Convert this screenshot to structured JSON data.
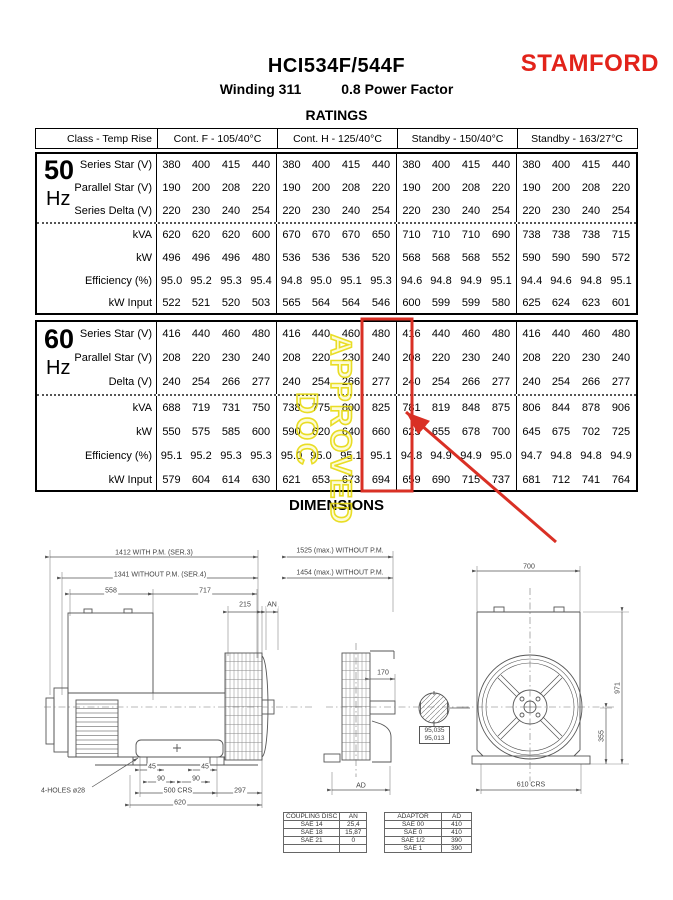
{
  "header": {
    "model": "HCI534F/544F",
    "subtitle_winding": "Winding 311",
    "subtitle_pf": "0.8 Power Factor",
    "brand": "STAMFORD"
  },
  "colors": {
    "brand_red": "#e2231a",
    "annotation_red": "#d93025",
    "watermark_yellow": "#e6d800"
  },
  "annotations": {
    "watermark": "APPROVED DOC"
  },
  "ratings": {
    "title": "RATINGS",
    "col_headers": [
      "Class - Temp Rise",
      "Cont. F - 105/40°C",
      "Cont. H - 125/40°C",
      "Standby - 150/40°C",
      "Standby - 163/27°C"
    ],
    "bands": [
      {
        "freq_big": "50",
        "freq_unit": "Hz",
        "rows": [
          {
            "label": "Series Star (V)",
            "groups": [
              [
                "380",
                "400",
                "415",
                "440"
              ],
              [
                "380",
                "400",
                "415",
                "440"
              ],
              [
                "380",
                "400",
                "415",
                "440"
              ],
              [
                "380",
                "400",
                "415",
                "440"
              ]
            ]
          },
          {
            "label": "Parallel Star (V)",
            "groups": [
              [
                "190",
                "200",
                "208",
                "220"
              ],
              [
                "190",
                "200",
                "208",
                "220"
              ],
              [
                "190",
                "200",
                "208",
                "220"
              ],
              [
                "190",
                "200",
                "208",
                "220"
              ]
            ]
          },
          {
            "label": "Series Delta (V)",
            "groups": [
              [
                "220",
                "230",
                "240",
                "254"
              ],
              [
                "220",
                "230",
                "240",
                "254"
              ],
              [
                "220",
                "230",
                "240",
                "254"
              ],
              [
                "220",
                "230",
                "240",
                "254"
              ]
            ]
          },
          {
            "label": "kVA",
            "groups": [
              [
                "620",
                "620",
                "620",
                "600"
              ],
              [
                "670",
                "670",
                "670",
                "650"
              ],
              [
                "710",
                "710",
                "710",
                "690"
              ],
              [
                "738",
                "738",
                "738",
                "715"
              ]
            ]
          },
          {
            "label": "kW",
            "groups": [
              [
                "496",
                "496",
                "496",
                "480"
              ],
              [
                "536",
                "536",
                "536",
                "520"
              ],
              [
                "568",
                "568",
                "568",
                "552"
              ],
              [
                "590",
                "590",
                "590",
                "572"
              ]
            ]
          },
          {
            "label": "Efficiency (%)",
            "groups": [
              [
                "95.0",
                "95.2",
                "95.3",
                "95.4"
              ],
              [
                "94.8",
                "95.0",
                "95.1",
                "95.3"
              ],
              [
                "94.6",
                "94.8",
                "94.9",
                "95.1"
              ],
              [
                "94.4",
                "94.6",
                "94.8",
                "95.1"
              ]
            ]
          },
          {
            "label": "kW Input",
            "groups": [
              [
                "522",
                "521",
                "520",
                "503"
              ],
              [
                "565",
                "564",
                "564",
                "546"
              ],
              [
                "600",
                "599",
                "599",
                "580"
              ],
              [
                "625",
                "624",
                "623",
                "601"
              ]
            ]
          }
        ]
      },
      {
        "freq_big": "60",
        "freq_unit": "Hz",
        "rows": [
          {
            "label": "Series Star (V)",
            "groups": [
              [
                "416",
                "440",
                "460",
                "480"
              ],
              [
                "416",
                "440",
                "460",
                "480"
              ],
              [
                "416",
                "440",
                "460",
                "480"
              ],
              [
                "416",
                "440",
                "460",
                "480"
              ]
            ]
          },
          {
            "label": "Parallel Star (V)",
            "groups": [
              [
                "208",
                "220",
                "230",
                "240"
              ],
              [
                "208",
                "220",
                "230",
                "240"
              ],
              [
                "208",
                "220",
                "230",
                "240"
              ],
              [
                "208",
                "220",
                "230",
                "240"
              ]
            ]
          },
          {
            "label": "Delta (V)",
            "groups": [
              [
                "240",
                "254",
                "266",
                "277"
              ],
              [
                "240",
                "254",
                "266",
                "277"
              ],
              [
                "240",
                "254",
                "266",
                "277"
              ],
              [
                "240",
                "254",
                "266",
                "277"
              ]
            ]
          },
          {
            "label": "kVA",
            "groups": [
              [
                "688",
                "719",
                "731",
                "750"
              ],
              [
                "738",
                "775",
                "800",
                "825"
              ],
              [
                "781",
                "819",
                "848",
                "875"
              ],
              [
                "806",
                "844",
                "878",
                "906"
              ]
            ]
          },
          {
            "label": "kW",
            "groups": [
              [
                "550",
                "575",
                "585",
                "600"
              ],
              [
                "590",
                "620",
                "640",
                "660"
              ],
              [
                "625",
                "655",
                "678",
                "700"
              ],
              [
                "645",
                "675",
                "702",
                "725"
              ]
            ]
          },
          {
            "label": "Efficiency (%)",
            "groups": [
              [
                "95.1",
                "95.2",
                "95.3",
                "95.3"
              ],
              [
                "95.0",
                "95.0",
                "95.1",
                "95.1"
              ],
              [
                "94.8",
                "94.9",
                "94.9",
                "95.0"
              ],
              [
                "94.7",
                "94.8",
                "94.8",
                "94.9"
              ]
            ]
          },
          {
            "label": "kW Input",
            "groups": [
              [
                "579",
                "604",
                "614",
                "630"
              ],
              [
                "621",
                "653",
                "673",
                "694"
              ],
              [
                "659",
                "690",
                "715",
                "737"
              ],
              [
                "681",
                "712",
                "741",
                "764"
              ]
            ]
          }
        ]
      }
    ]
  },
  "dimensions": {
    "title": "DIMENSIONS",
    "left": [
      "1412 WITH P.M. (SER.3)",
      "1341 WITHOUT P.M. (SER.4)",
      "558",
      "717",
      "215",
      "AN",
      "45",
      "45",
      "90",
      "90",
      "500 CRS",
      "297",
      "620",
      "4-HOLES ø28"
    ],
    "mid": [
      "1525 (max.) WITHOUT P.M.",
      "1454 (max.) WITHOUT P.M.",
      "170",
      "AD"
    ],
    "shaft_tol": [
      "95,035",
      "95,013"
    ],
    "right": [
      "700",
      "971",
      "355",
      "610 CRS"
    ]
  },
  "sae_tables": {
    "coupling": {
      "headers": [
        "COUPLING DISC",
        "AN"
      ],
      "rows": [
        [
          "SAE 14",
          "25,4"
        ],
        [
          "SAE 18",
          "15,87"
        ],
        [
          "SAE 21",
          "0"
        ],
        [
          "",
          ""
        ]
      ]
    },
    "adaptor": {
      "headers": [
        "ADAPTOR",
        "AD"
      ],
      "rows": [
        [
          "SAE 00",
          "410"
        ],
        [
          "SAE 0",
          "410"
        ],
        [
          "SAE 1/2",
          "390"
        ],
        [
          "SAE 1",
          "390"
        ]
      ]
    }
  }
}
